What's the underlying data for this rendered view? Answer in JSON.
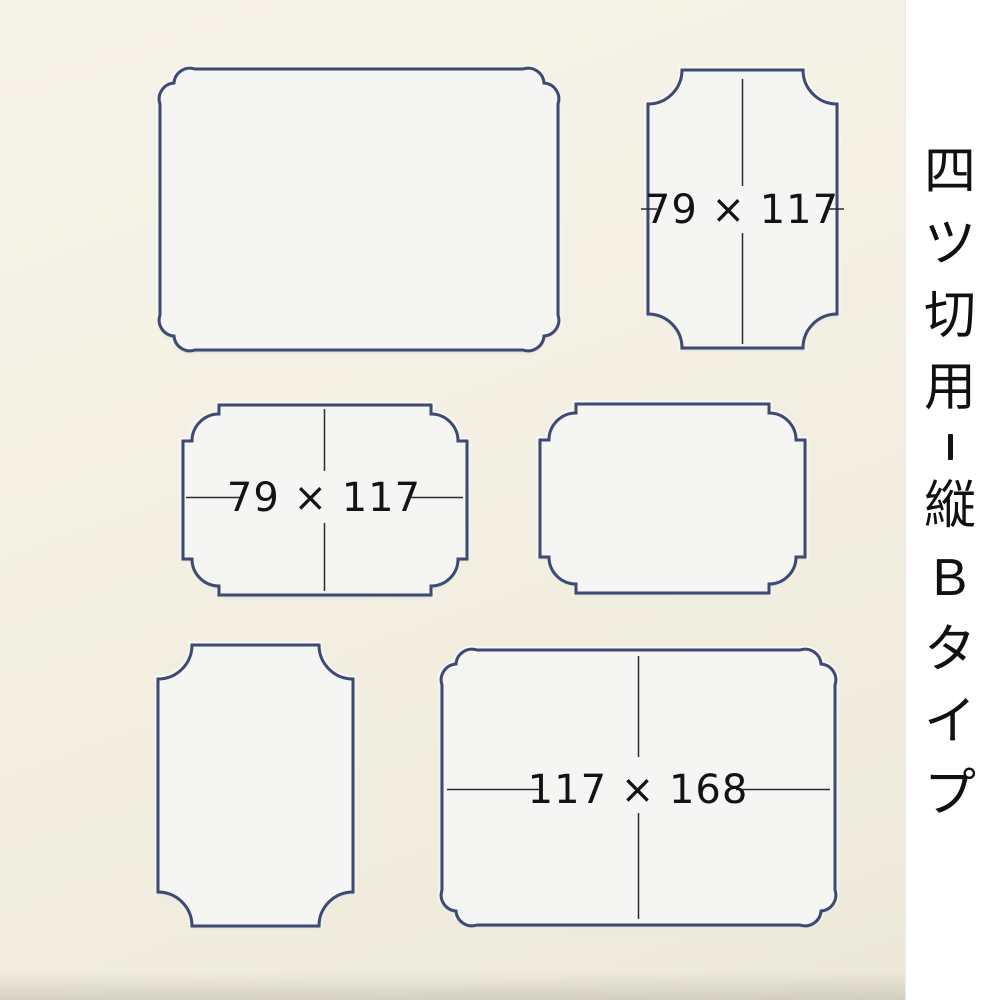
{
  "photo": {
    "mat_color": "#f3f0e3",
    "keyline_color": "#3e4a74",
    "window_fill": "#f5f5f3",
    "dimension_line_color": "#2b2b2b",
    "label_color": "#131313"
  },
  "caption": {
    "text": "四ツ切用-縦Bタイプ"
  },
  "windows": [
    {
      "id": "top-left-large",
      "corner_style": "scalloped-corners",
      "label": ""
    },
    {
      "id": "top-right",
      "corner_style": "concave-corners",
      "label": "79 × 117"
    },
    {
      "id": "middle-left",
      "corner_style": "step-corners",
      "label": "79 × 117"
    },
    {
      "id": "middle-right",
      "corner_style": "step-corners",
      "label": ""
    },
    {
      "id": "bottom-left",
      "corner_style": "concave-corners",
      "label": ""
    },
    {
      "id": "bottom-right",
      "corner_style": "scalloped-corners",
      "label": "117 × 168"
    }
  ]
}
